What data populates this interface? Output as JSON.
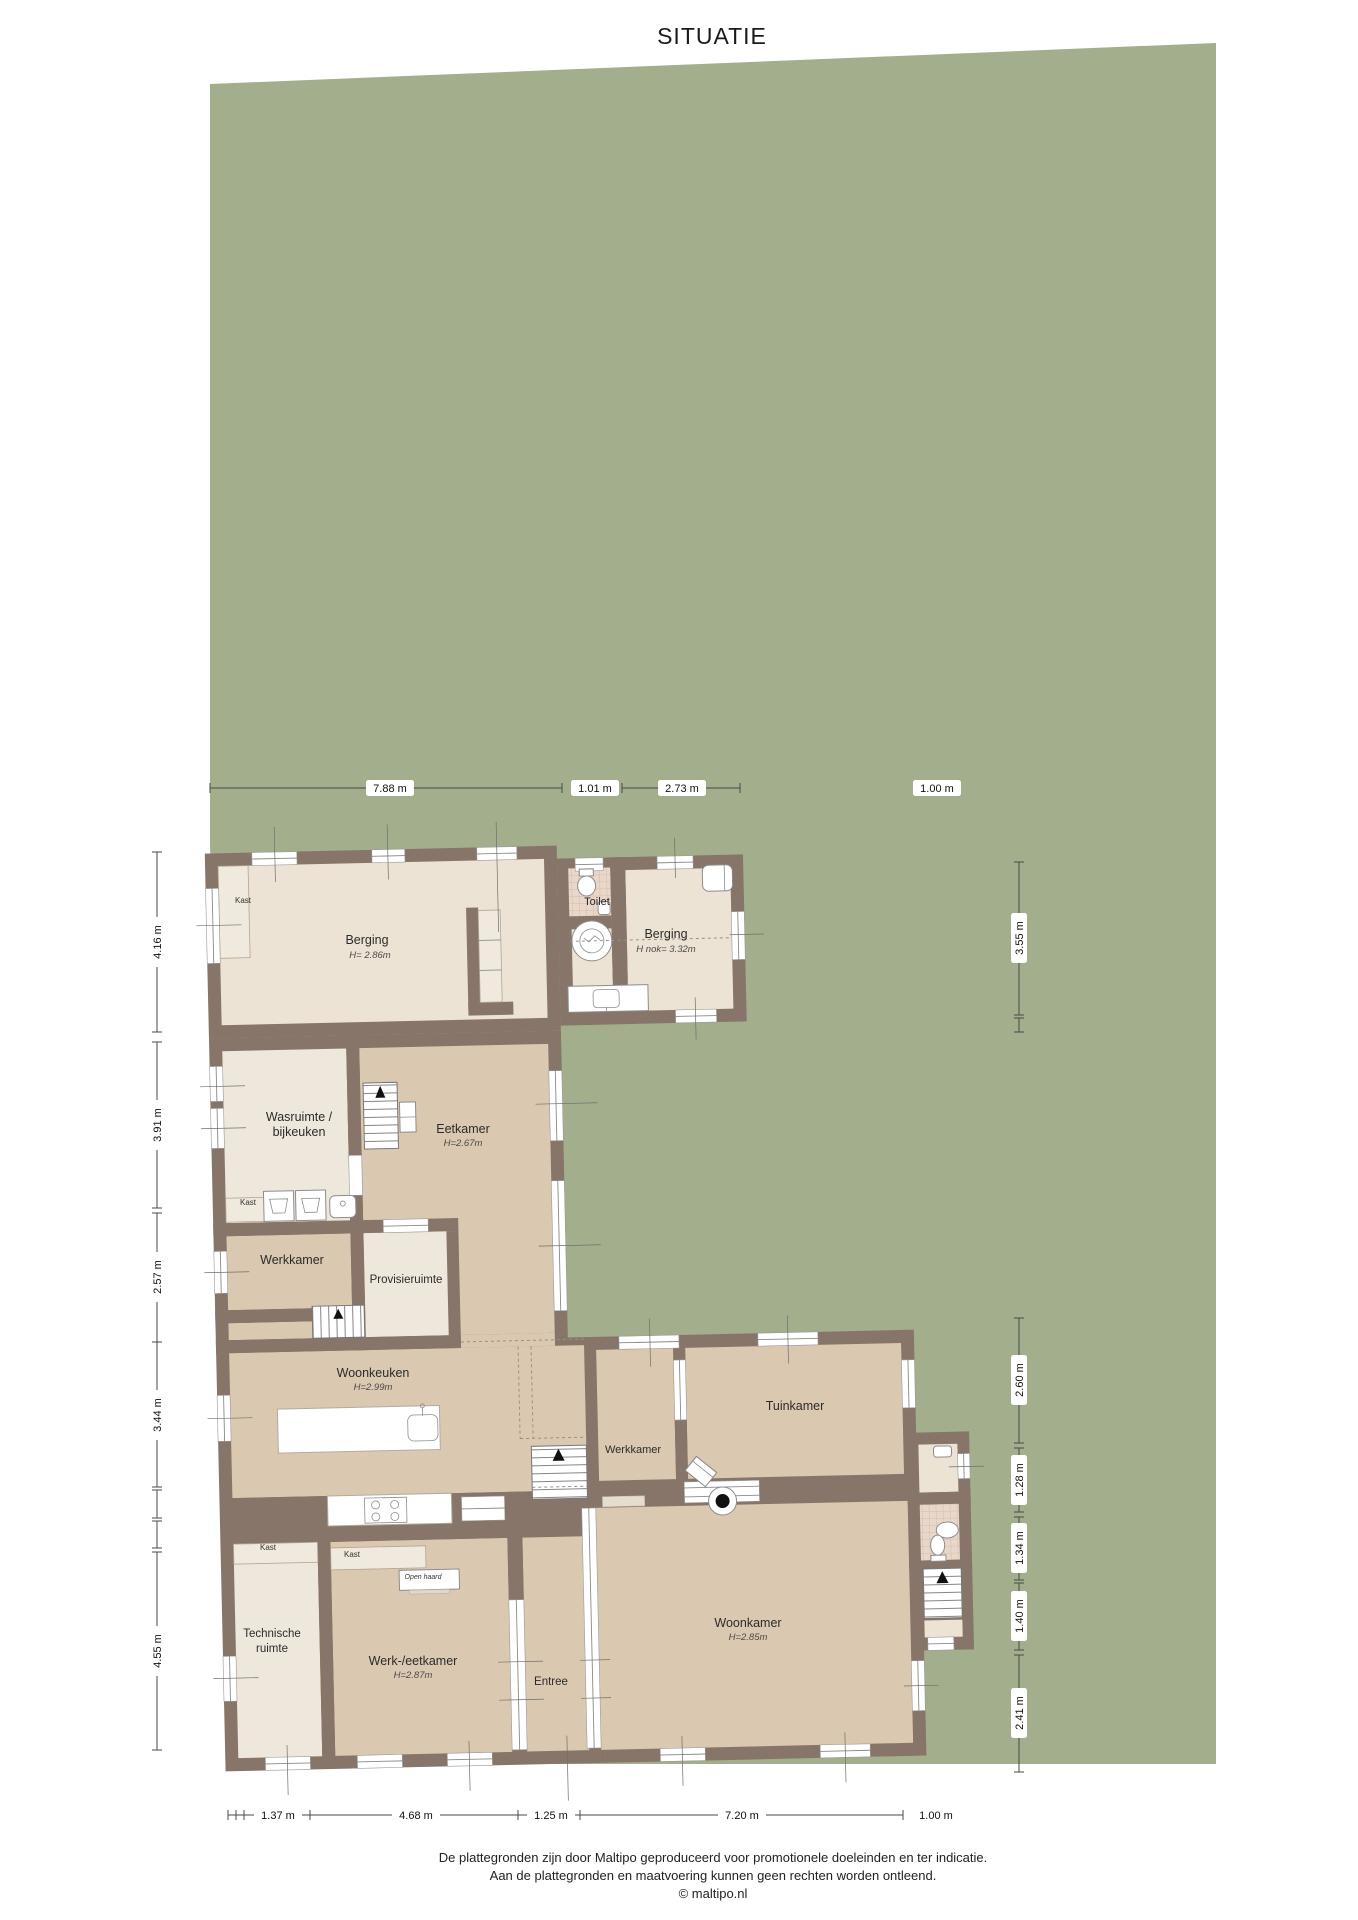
{
  "title": "SITUATIE",
  "colors": {
    "lot_green": "#a2ae8c",
    "wall_brown": "#867568",
    "floor_tan": "#dbc8b1",
    "floor_cream": "#eee7db",
    "tile": "#e9d7c9"
  },
  "rooms": {
    "berging1": {
      "label": "Berging",
      "height": "H= 2.86m"
    },
    "toilet": {
      "label": "Toilet"
    },
    "berging2": {
      "label": "Berging",
      "height": "H nok= 3.32m"
    },
    "wasruimte": {
      "label_line1": "Wasruimte /",
      "label_line2": "bijkeuken"
    },
    "eetkamer": {
      "label": "Eetkamer",
      "height": "H=2.67m"
    },
    "werkkamer_links": {
      "label": "Werkkamer"
    },
    "provisieruimte": {
      "label": "Provisieruimte"
    },
    "woonkeuken": {
      "label": "Woonkeuken",
      "height": "H=2.99m"
    },
    "werkkamer_midden": {
      "label": "Werkkamer"
    },
    "tuinkamer": {
      "label": "Tuinkamer"
    },
    "woonkamer": {
      "label": "Woonkamer",
      "height": "H=2.85m"
    },
    "technische_ruimte": {
      "label_line1": "Technische",
      "label_line2": "ruimte"
    },
    "werk_eetkamer": {
      "label": "Werk-/eetkamer",
      "height": "H=2.87m"
    },
    "entree": {
      "label": "Entree"
    }
  },
  "features": {
    "kast": "Kast",
    "open_haard": "Open haard"
  },
  "dimensions": {
    "top": [
      "7.88 m",
      "1.01 m",
      "2.73 m",
      "1.00 m"
    ],
    "left": [
      "4.16 m",
      "3.91 m",
      "2.57 m",
      "3.44 m",
      "4.55 m"
    ],
    "right": [
      "3.55 m",
      "2.60 m",
      "1.28 m",
      "1.34 m",
      "1.40 m",
      "2.41 m"
    ],
    "bottom": [
      "1.37 m",
      "4.68 m",
      "1.25 m",
      "7.20 m",
      "1.00 m"
    ]
  },
  "footer": {
    "line1": "De plattegronden zijn door Maltipo geproduceerd voor promotionele doeleinden en ter indicatie.",
    "line2": "Aan de plattegronden en maatvoering kunnen geen rechten worden ontleend.",
    "line3": "© maltipo.nl"
  }
}
